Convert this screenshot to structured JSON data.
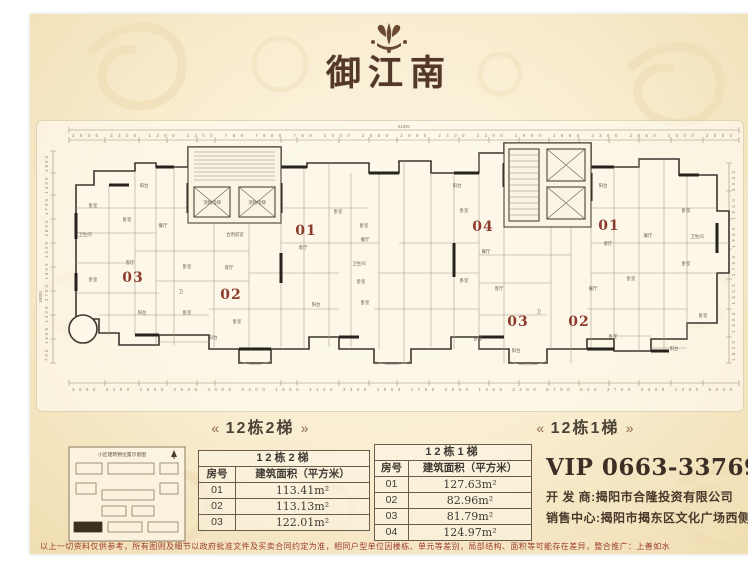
{
  "logo": {
    "title": "御江南"
  },
  "plan": {
    "captions": {
      "left": "12栋2梯",
      "right": "12栋1梯",
      "flourish_left": "«",
      "flourish_right": "»"
    },
    "dims": {
      "top_total": "51000",
      "top": "3000 3300 1300 2300 750 7800 750 4000 2550 3000 2400 3300 2900 2850 2300 2850 4000 3000",
      "bottom": "3000 4100 1600 2600 4000 3300 1900 3100 3300 1900 1750 3800 1200 3200 5700 900 3700 3300 1200 5000",
      "left_total": "19000",
      "left": "700 1500 1300 2700 1900 1300 2800 1700 1300 1800",
      "right": "1800 1300 1500 2700 1900 1500 3000"
    },
    "units": [
      {
        "x": 94,
        "y": 159,
        "t": "03"
      },
      {
        "x": 192,
        "y": 176,
        "t": "02"
      },
      {
        "x": 267,
        "y": 112,
        "t": "01"
      },
      {
        "x": 444,
        "y": 108,
        "t": "04"
      },
      {
        "x": 570,
        "y": 107,
        "t": "01"
      },
      {
        "x": 479,
        "y": 203,
        "t": "03"
      },
      {
        "x": 540,
        "y": 203,
        "t": "02"
      }
    ],
    "rooms": [
      {
        "x": 54,
        "y": 84,
        "t": "卧室"
      },
      {
        "x": 88,
        "y": 98,
        "t": "卧室"
      },
      {
        "x": 105,
        "y": 64,
        "t": "阳台"
      },
      {
        "x": 46,
        "y": 113,
        "t": "卫生间"
      },
      {
        "x": 54,
        "y": 158,
        "t": "卧室"
      },
      {
        "x": 103,
        "y": 191,
        "t": "阳台"
      },
      {
        "x": 148,
        "y": 145,
        "t": "卧室"
      },
      {
        "x": 124,
        "y": 104,
        "t": "餐厅"
      },
      {
        "x": 91,
        "y": 141,
        "t": "客厅"
      },
      {
        "x": 148,
        "y": 191,
        "t": "卧室"
      },
      {
        "x": 190,
        "y": 146,
        "t": "客厅"
      },
      {
        "x": 174,
        "y": 216,
        "t": "阳台"
      },
      {
        "x": 198,
        "y": 200,
        "t": "卧室"
      },
      {
        "x": 142,
        "y": 170,
        "t": "卫"
      },
      {
        "x": 173,
        "y": 81,
        "t": "消防电梯"
      },
      {
        "x": 218,
        "y": 81,
        "t": "消防电梯"
      },
      {
        "x": 196,
        "y": 113,
        "t": "合用前室"
      },
      {
        "x": 299,
        "y": 90,
        "t": "卧室"
      },
      {
        "x": 264,
        "y": 126,
        "t": "客厅"
      },
      {
        "x": 325,
        "y": 104,
        "t": "卧室"
      },
      {
        "x": 320,
        "y": 142,
        "t": "卫生间"
      },
      {
        "x": 322,
        "y": 160,
        "t": "卧室"
      },
      {
        "x": 326,
        "y": 181,
        "t": "卧室"
      },
      {
        "x": 277,
        "y": 183,
        "t": "阳台"
      },
      {
        "x": 326,
        "y": 118,
        "t": "餐厅"
      },
      {
        "x": 418,
        "y": 64,
        "t": "阳台"
      },
      {
        "x": 425,
        "y": 89,
        "t": "卧室"
      },
      {
        "x": 447,
        "y": 130,
        "t": "餐厅"
      },
      {
        "x": 564,
        "y": 64,
        "t": "阳台"
      },
      {
        "x": 647,
        "y": 89,
        "t": "卧室"
      },
      {
        "x": 609,
        "y": 114,
        "t": "餐厅"
      },
      {
        "x": 569,
        "y": 122,
        "t": "客厅"
      },
      {
        "x": 647,
        "y": 142,
        "t": "卧室"
      },
      {
        "x": 658,
        "y": 115,
        "t": "卫生间"
      },
      {
        "x": 425,
        "y": 159,
        "t": "卧室"
      },
      {
        "x": 460,
        "y": 167,
        "t": "客厅"
      },
      {
        "x": 554,
        "y": 167,
        "t": "餐厅"
      },
      {
        "x": 592,
        "y": 157,
        "t": "卧室"
      },
      {
        "x": 439,
        "y": 217,
        "t": "卧室"
      },
      {
        "x": 477,
        "y": 229,
        "t": "阳台"
      },
      {
        "x": 574,
        "y": 215,
        "t": "卧室"
      },
      {
        "x": 635,
        "y": 227,
        "t": "阳台"
      },
      {
        "x": 664,
        "y": 194,
        "t": "卧室"
      },
      {
        "x": 500,
        "y": 190,
        "t": "卫"
      }
    ]
  },
  "sitemap": {
    "title": "小区建筑物位置示意图"
  },
  "tables": {
    "t1": {
      "title": "12栋2梯",
      "headers": [
        "房号",
        "建筑面积（平方米）"
      ],
      "rows": [
        [
          "01",
          "113.41m²"
        ],
        [
          "02",
          "113.13m²"
        ],
        [
          "03",
          "122.01m²"
        ]
      ]
    },
    "t2": {
      "title": "12栋1梯",
      "headers": [
        "房号",
        "建筑面积（平方米）"
      ],
      "rows": [
        [
          "01",
          "127.63m²"
        ],
        [
          "02",
          "82.96m²"
        ],
        [
          "03",
          "81.79m²"
        ],
        [
          "04",
          "124.97m²"
        ]
      ]
    }
  },
  "contact": {
    "vip": "VIP 0663-3376999",
    "developer": "开 发 商:揭阳市合隆投资有限公司",
    "sales": "销售中心:揭阳市揭东区文化广场西侧"
  },
  "disclaimer": "以上一切资料仅供参考，所有图则及细节以政府批准文件及买卖合同约定为准，相同户型单位因楼栋、单元等差别，局部结构、面积等可能存在差异，整合推广：上善如水",
  "colors": {
    "accent": "#8c3c2c",
    "paper": "#f6e9cc",
    "ink": "#3f3a33"
  }
}
